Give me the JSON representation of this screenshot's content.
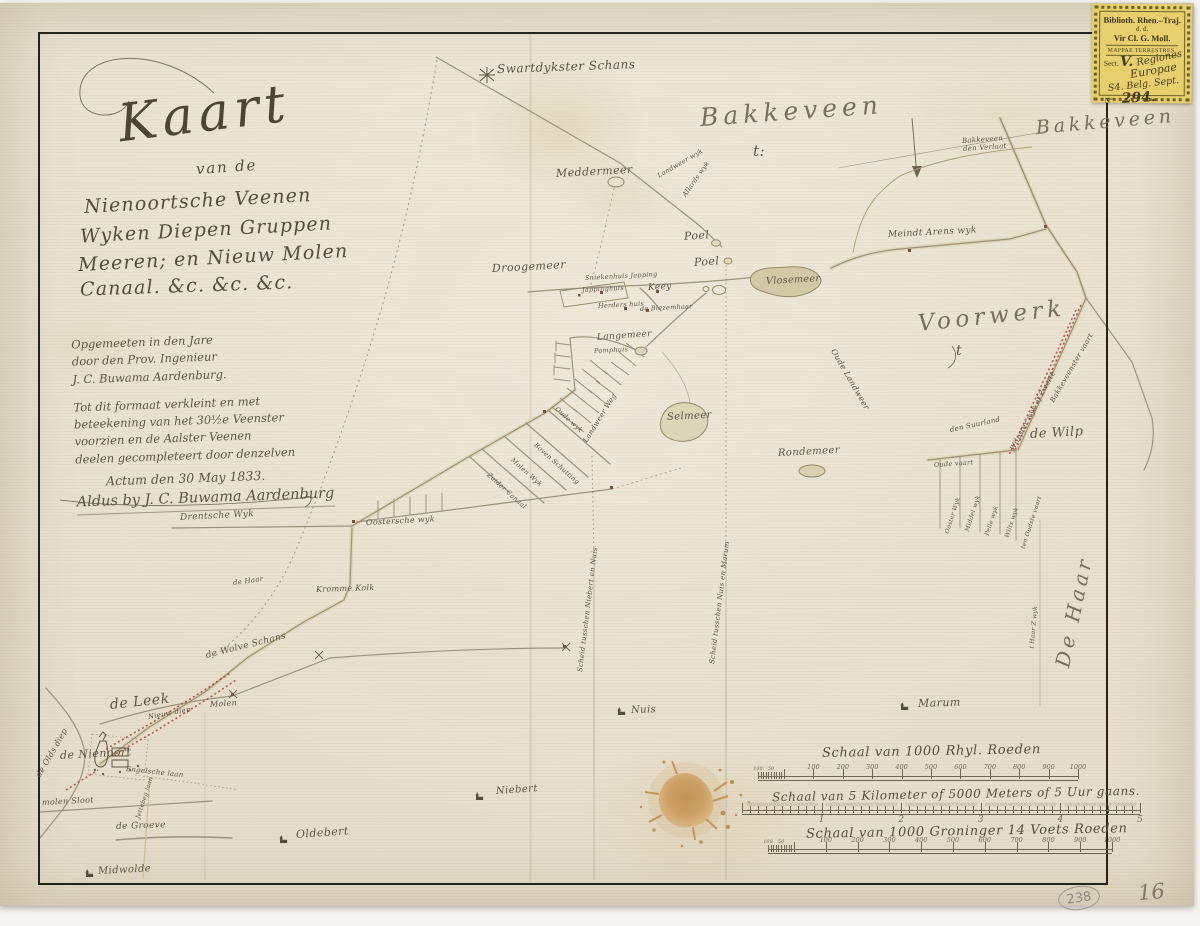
{
  "palette": {
    "paper": "#ebe4d2",
    "ink": "#5d5444",
    "red": "#b2403a",
    "stamp_bg": "#e7cf6e",
    "blot": "#c2905a"
  },
  "title_block": {
    "title": "Kaart",
    "subtitle": "van de",
    "lines": [
      "Nienoortsche Veenen",
      "Wyken Diepen Gruppen",
      "Meeren; en Nieuw Molen",
      "Canaal. &c. &c. &c."
    ]
  },
  "legend_block": {
    "lines": [
      "Opgemeeten in den Jare",
      "door den Prov. Ingenieur",
      "J. C. Buwama Aardenburg.",
      "Tot dit formaat verkleint en met",
      "beteekening van het 30½e Veenster",
      "voorzien en de Aalster Veenen",
      "deelen gecompleteert door denzelven",
      "Actum den 30 May 1833.",
      "Aldus by J. C. Buwama Aardenburg"
    ]
  },
  "stamp": {
    "line1": "Biblioth. Rhen.–Traj.",
    "line2": "d. d.",
    "line3": "Vir Cl. G. Moll.",
    "line4": "MAPPAE TERRESTRES.",
    "sect": "Sect.",
    "hw_v": "V.",
    "hw_regiones": "Regiones",
    "hw_europae": "Europae",
    "hw_shelf": "S4. Belg. Sept.",
    "no": "Nº",
    "hw_no": "294."
  },
  "pencil": {
    "circled": "238",
    "page_no": "16"
  },
  "map_labels": [
    {
      "n": "label-swartdykster-schans",
      "t": "Swartdykster Schans",
      "x": 497,
      "y": 62,
      "s": 12,
      "r": -2
    },
    {
      "n": "label-bakkeveen",
      "t": "Bakkeveen",
      "x": 700,
      "y": 103,
      "s": 25,
      "r": -4,
      "cls": "big"
    },
    {
      "n": "label-bakkeveen-flourish",
      "t": "t:",
      "x": 753,
      "y": 142,
      "s": 15,
      "r": 0
    },
    {
      "n": "label-bakkeveen-east",
      "t": "Bakkeveen",
      "x": 1036,
      "y": 117,
      "s": 19,
      "r": -5,
      "cls": "big"
    },
    {
      "n": "label-bakkeveenster-verlaat-1",
      "t": "Bakkeveen",
      "x": 962,
      "y": 137,
      "s": 7,
      "r": -4
    },
    {
      "n": "label-bakkeveenster-verlaat-2",
      "t": "den Verlaat",
      "x": 963,
      "y": 145,
      "s": 7,
      "r": -4
    },
    {
      "n": "label-meddermeer",
      "t": "Meddermeer",
      "x": 556,
      "y": 167,
      "s": 11,
      "r": -3
    },
    {
      "n": "label-landweer-wyk",
      "t": "Landweer wyk",
      "x": 658,
      "y": 172,
      "s": 6.5,
      "r": -30
    },
    {
      "n": "label-allards-wyk",
      "t": "Allards wyk",
      "x": 684,
      "y": 192,
      "s": 6.5,
      "r": -55
    },
    {
      "n": "label-meindert-arens-wyk",
      "t": "Meindt Arens wyk",
      "x": 888,
      "y": 230,
      "s": 9,
      "r": -3
    },
    {
      "n": "label-poel-1",
      "t": "Poel",
      "x": 684,
      "y": 230,
      "s": 11,
      "r": -4
    },
    {
      "n": "label-poel-2",
      "t": "Poel",
      "x": 694,
      "y": 256,
      "s": 11,
      "r": -4
    },
    {
      "n": "label-vlosemeer",
      "t": "Vlosemeer",
      "x": 766,
      "y": 276,
      "s": 9.5,
      "r": -3
    },
    {
      "n": "label-droogemeer",
      "t": "Droogemeer",
      "x": 492,
      "y": 262,
      "s": 11,
      "r": -3
    },
    {
      "n": "label-sniekenhuis-japping",
      "t": "Sniekenhuis Japping",
      "x": 585,
      "y": 274,
      "s": 6.5,
      "r": -3
    },
    {
      "n": "label-jappinghuis",
      "t": "Jappinghuis",
      "x": 582,
      "y": 286,
      "s": 6.5,
      "r": -3
    },
    {
      "n": "label-keey",
      "t": "Keey",
      "x": 648,
      "y": 283,
      "s": 9,
      "r": -3
    },
    {
      "n": "label-herders-huis",
      "t": "Herders huis",
      "x": 598,
      "y": 302,
      "s": 6.5,
      "r": -3
    },
    {
      "n": "label-de-biezemhaar",
      "t": "de Biezemhaar",
      "x": 640,
      "y": 305,
      "s": 6.5,
      "r": -3
    },
    {
      "n": "label-langemeer",
      "t": "Langemeer",
      "x": 597,
      "y": 333,
      "s": 9,
      "r": -4
    },
    {
      "n": "label-pomphuis",
      "t": "Pomphuis",
      "x": 594,
      "y": 347,
      "s": 6.5,
      "r": -3
    },
    {
      "n": "label-selmeer",
      "t": "Selmeer",
      "x": 667,
      "y": 412,
      "s": 10,
      "r": -3
    },
    {
      "n": "label-rondemeer",
      "t": "Rondemeer",
      "x": 778,
      "y": 448,
      "s": 10,
      "r": -3
    },
    {
      "n": "label-voorwerk",
      "t": "Voorwerk",
      "x": 918,
      "y": 311,
      "s": 23,
      "r": -6,
      "cls": "big"
    },
    {
      "n": "label-voorwerk-flourish",
      "t": "t",
      "x": 956,
      "y": 343,
      "s": 14,
      "r": 0
    },
    {
      "n": "label-den-suurland",
      "t": "den Suurland",
      "x": 950,
      "y": 426,
      "s": 7,
      "r": -12
    },
    {
      "n": "label-de-wilp",
      "t": "de Wilp",
      "x": 1030,
      "y": 427,
      "s": 13,
      "r": -3
    },
    {
      "n": "label-oude-vaart",
      "t": "Oude vaart",
      "x": 934,
      "y": 461,
      "s": 6.5,
      "r": -4
    },
    {
      "n": "label-ooster-wyk",
      "t": "Ooster Wyk",
      "x": 947,
      "y": 530,
      "s": 6,
      "r": -72
    },
    {
      "n": "label-middel-wyk",
      "t": "Middel wyk",
      "x": 967,
      "y": 528,
      "s": 6,
      "r": -72
    },
    {
      "n": "label-pelle-wyk",
      "t": "Pelle wyk",
      "x": 987,
      "y": 532,
      "s": 6,
      "r": -72
    },
    {
      "n": "label-wilts-wyk",
      "t": "Wilts wyk",
      "x": 1007,
      "y": 534,
      "s": 6,
      "r": -72
    },
    {
      "n": "label-oudste-vaart",
      "t": "ten Oudste vaart",
      "x": 1023,
      "y": 545,
      "s": 6,
      "r": -72
    },
    {
      "n": "label-wilpster-wyk",
      "t": "Wilpster wyk of Zwette",
      "x": 1012,
      "y": 446,
      "s": 7,
      "r": -62
    },
    {
      "n": "label-bakkeveenster-vaart",
      "t": "Bakkeveenster vaart",
      "x": 1052,
      "y": 398,
      "s": 7,
      "r": -60
    },
    {
      "n": "label-oude-landweer",
      "t": "Oude Landweer",
      "x": 833,
      "y": 345,
      "s": 8,
      "r": 60
    },
    {
      "n": "label-landweer-weg",
      "t": "Landweer Weg",
      "x": 585,
      "y": 438,
      "s": 7,
      "r": -58
    },
    {
      "n": "label-de-haar",
      "t": "De Haar",
      "x": 1062,
      "y": 655,
      "s": 20,
      "r": -78,
      "cls": "big"
    },
    {
      "n": "label-t-haar-wyk",
      "t": "t Haar Z wyk",
      "x": 1032,
      "y": 645,
      "s": 6,
      "r": -85
    },
    {
      "n": "label-marum",
      "t": "Marum",
      "x": 918,
      "y": 697,
      "s": 11,
      "r": -2
    },
    {
      "n": "label-nuis",
      "t": "Nuis",
      "x": 631,
      "y": 705,
      "s": 10,
      "r": -2
    },
    {
      "n": "label-niebert",
      "t": "Niebert",
      "x": 496,
      "y": 786,
      "s": 10,
      "r": -4
    },
    {
      "n": "label-oldebert",
      "t": "Oldebert",
      "x": 296,
      "y": 828,
      "s": 11,
      "r": -4
    },
    {
      "n": "label-midwolde",
      "t": "Midwolde",
      "x": 98,
      "y": 866,
      "s": 10,
      "r": -3
    },
    {
      "n": "label-de-leek",
      "t": "de Leek",
      "x": 110,
      "y": 697,
      "s": 14,
      "r": -6
    },
    {
      "n": "label-de-nienoort",
      "t": "de Nienoort",
      "x": 60,
      "y": 749,
      "s": 11,
      "r": -3
    },
    {
      "n": "label-engelsche-laan",
      "t": "Engelsche laan",
      "x": 126,
      "y": 765,
      "s": 7,
      "r": 6
    },
    {
      "n": "label-jettebeg-laan",
      "t": "Jettebeg laan",
      "x": 138,
      "y": 815,
      "s": 6,
      "r": -72
    },
    {
      "n": "label-molen-sloot",
      "t": "molen Sloot",
      "x": 42,
      "y": 798,
      "s": 8,
      "r": -3
    },
    {
      "n": "label-de-groeve",
      "t": "de Groeve",
      "x": 116,
      "y": 822,
      "s": 9,
      "r": -2
    },
    {
      "n": "label-olds-diep",
      "t": "de Olds diep",
      "x": 38,
      "y": 772,
      "s": 8,
      "r": -60
    },
    {
      "n": "label-nieuw-diep",
      "t": "Nieuw diep",
      "x": 148,
      "y": 713,
      "s": 7,
      "r": -10
    },
    {
      "n": "label-molen",
      "t": "Molen",
      "x": 210,
      "y": 700,
      "s": 8,
      "r": -4
    },
    {
      "n": "label-drentsche-wyk",
      "t": "Drentsche Wyk",
      "x": 180,
      "y": 513,
      "s": 9,
      "r": -3
    },
    {
      "n": "label-oostersche-wyk",
      "t": "Oostersche wyk",
      "x": 366,
      "y": 518,
      "s": 8,
      "r": -3
    },
    {
      "n": "label-kromme-kolk",
      "t": "Kromme Kolk",
      "x": 316,
      "y": 585,
      "s": 8,
      "r": -2
    },
    {
      "n": "label-de-haar-klein",
      "t": "de Haar",
      "x": 233,
      "y": 579,
      "s": 7,
      "r": -8
    },
    {
      "n": "label-wolve-schans",
      "t": "de Wolve Schans",
      "x": 206,
      "y": 651,
      "s": 9,
      "r": -14
    },
    {
      "n": "label-scheiding-niebert-nuis",
      "t": "Scheid tusschen Niebert en Nuis",
      "x": 580,
      "y": 668,
      "s": 7,
      "r": -83
    },
    {
      "n": "label-scheiding-nuis-marum",
      "t": "Scheid tusschen Nuis en Marum",
      "x": 712,
      "y": 660,
      "s": 7,
      "r": -83
    },
    {
      "n": "label-oude-wyk",
      "t": "Oude wyk",
      "x": 556,
      "y": 404,
      "s": 6.5,
      "r": 42
    },
    {
      "n": "label-boven-schutting",
      "t": "Boven Schutting",
      "x": 535,
      "y": 440,
      "s": 6.5,
      "r": 42
    },
    {
      "n": "label-molen-wyk",
      "t": "Molen Wyk",
      "x": 512,
      "y": 455,
      "s": 6.5,
      "r": 42
    },
    {
      "n": "label-zuider-canaal",
      "t": "Zuider Canaal",
      "x": 488,
      "y": 470,
      "s": 6.5,
      "r": 42
    }
  ],
  "scale_bars": [
    {
      "n": "scale-rijnlandse-roeden",
      "title": "Schaal van 1000 Rhyl. Roeden",
      "tx": 822,
      "ty": 744,
      "ts": 13,
      "x1": 758,
      "x2": 1078,
      "y": 776,
      "tail": true,
      "tail_labels": [
        "100",
        "50"
      ],
      "labels": [
        "100",
        "200",
        "300",
        "400",
        "500",
        "600",
        "700",
        "800",
        "900",
        "1000"
      ]
    },
    {
      "n": "scale-kilometers",
      "title": "Schaal van 5 Kilometer of 5000 Meters of 5 Uur gaans.",
      "tx": 772,
      "ty": 787,
      "ts": 12,
      "x1": 742,
      "x2": 1140,
      "y": 810,
      "kms": [
        "1",
        "2",
        "3",
        "4",
        "5"
      ],
      "subs": [
        "100",
        "200",
        "300",
        "400",
        "500",
        "600",
        "700",
        "800",
        "900"
      ]
    },
    {
      "n": "scale-groninger-roeden",
      "title": "Schaal van 1000 Groninger 14 Voets Roeden",
      "tx": 806,
      "ty": 824,
      "ts": 13,
      "x1": 768,
      "x2": 1112,
      "y": 849,
      "tail": true,
      "tail_labels": [
        "100",
        "50"
      ],
      "labels": [
        "100",
        "200",
        "300",
        "400",
        "500",
        "600",
        "700",
        "800",
        "900",
        "1000"
      ]
    }
  ]
}
